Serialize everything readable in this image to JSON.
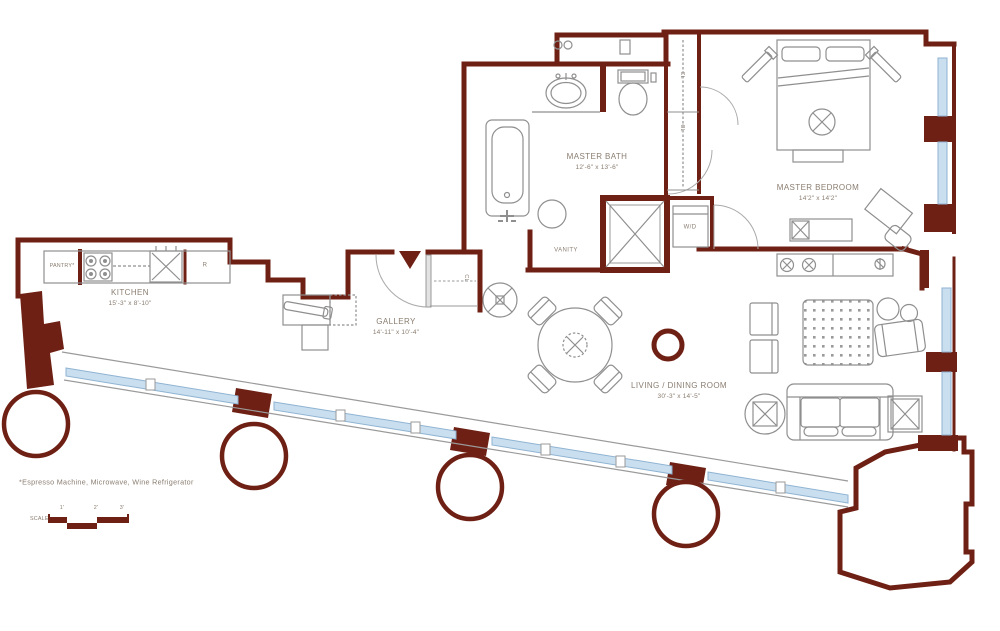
{
  "plan": {
    "type": "residential-floor-plan",
    "rooms": {
      "master_bath": {
        "name": "MASTER BATH",
        "dims": "12'-6\" x 13'-6\""
      },
      "master_bedroom": {
        "name": "MASTER BEDROOM",
        "dims": "14'2\" x 14'2\""
      },
      "kitchen": {
        "name": "KITCHEN",
        "dims": "15'-3\" x 8'-10\""
      },
      "gallery": {
        "name": "GALLERY",
        "dims": "14'-11\" x 10'-4\""
      },
      "living_dining": {
        "name": "LIVING / DINING ROOM",
        "dims": "30'-3\" x 14'-5\""
      }
    },
    "labels": {
      "vanity": "VANITY",
      "pantry": "PANTRY*",
      "washer_dryer": "W/D",
      "refrigerator": "R",
      "closet_entry": "CL",
      "closet_bedroom_1": "CL",
      "closet_bedroom_2": "CL"
    },
    "footnote": "*Espresso Machine, Microwave, Wine Refrigerator",
    "scale_bar": {
      "label": "SCALE",
      "ticks": [
        "1'",
        "2'",
        "3'"
      ]
    },
    "colors": {
      "wall": "#6f2014",
      "window_fill": "#c9dff0",
      "window_edge": "#8fb3d2",
      "furniture_line": "#8f8f8f",
      "label_text": "#8a7d70"
    }
  }
}
